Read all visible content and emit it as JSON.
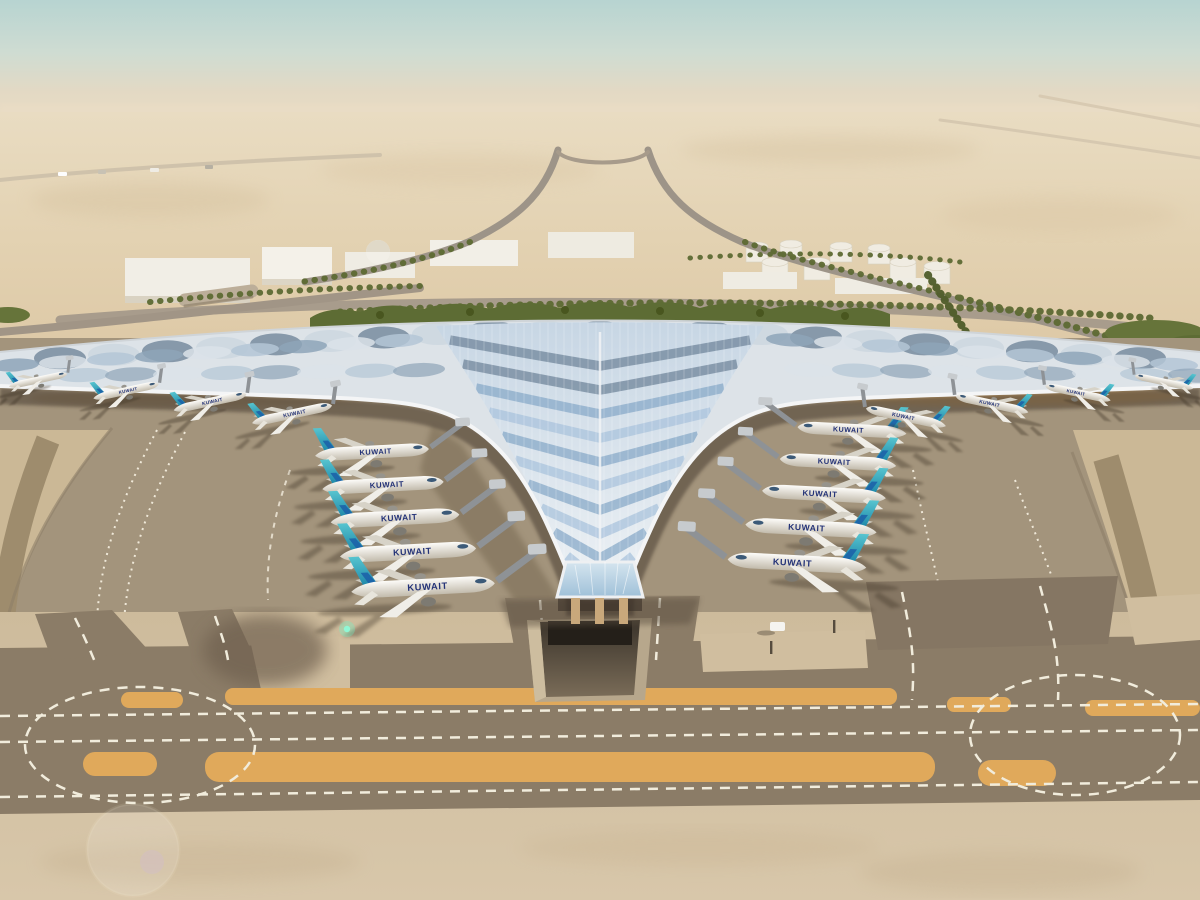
{
  "scene": {
    "sky_top": "#b7d4d1",
    "sky_mid": "#cfdcd2",
    "sky_horizon": "#e6d9c3",
    "desert_far": "#e9dcc2",
    "desert_near": "#ddc8a5",
    "greenery": "#5d6c34",
    "palm_line": "#5d6a33",
    "road": "#9d9488"
  },
  "ground": {
    "apron": "#a3947c",
    "taxiway_dark": "#8b7c67",
    "pavement_light": "#d2c0a2",
    "sand_strip_color": "#e0a95b",
    "dash_color": "#f1ecdc",
    "stand_line_color": "#efe8d8",
    "wedge_stripe": "#9e8c6d"
  },
  "terminal": {
    "roof_base": "#dde3e8",
    "canopy_top": "#c7d6e4",
    "canopy_bottom": "#eef2f5",
    "chevron_light": "#a9c3dc",
    "chevron_mid": "#88a9c8",
    "chevron_dark": "#70869b",
    "bump_dark": "#7d90a3",
    "bump_light": "#cdd7e0",
    "edge_trim": "#f4f5f6",
    "under_shadow": "#41362a",
    "column_tan": "#c9a87b",
    "glass_light": "#d5e5ef",
    "glass_deep": "#9fc0d8"
  },
  "aircraft": {
    "livery_label": "KUWAIT",
    "label_color": "#233277",
    "tail_teal_light": "#57c4cf",
    "tail_teal_deep": "#1d86a8",
    "tail_accent_blue": "#1b5fa8",
    "fuselage_top": "#fdfcf9",
    "fuselage_bottom": "#c2bbac",
    "groups": [
      {
        "name": "left-gate-column",
        "dir": 1,
        "rotation": -3,
        "bridge": [
          36,
          -24
        ],
        "planes": [
          [
            372,
            452,
            0.92
          ],
          [
            383,
            485,
            0.98
          ],
          [
            395,
            518,
            1.04
          ],
          [
            408,
            552,
            1.1
          ],
          [
            423,
            587,
            1.16
          ]
        ]
      },
      {
        "name": "right-gate-column",
        "dir": -1,
        "rotation": 3,
        "bridge": [
          36,
          -24
        ],
        "planes": [
          [
            852,
            430,
            0.88
          ],
          [
            838,
            462,
            0.94
          ],
          [
            824,
            494,
            1.0
          ],
          [
            811,
            528,
            1.06
          ],
          [
            797,
            563,
            1.12
          ]
        ]
      },
      {
        "name": "left-wing-row",
        "dir": 1,
        "rotation": -12,
        "bridge": [
          10,
          -28
        ],
        "planes": [
          [
            38,
            380,
            0.48
          ],
          [
            126,
            391,
            0.54
          ],
          [
            210,
            402,
            0.6
          ],
          [
            292,
            414,
            0.66
          ]
        ]
      },
      {
        "name": "right-wing-row",
        "dir": -1,
        "rotation": 12,
        "bridge": [
          10,
          -28
        ],
        "planes": [
          [
            1164,
            382,
            0.48
          ],
          [
            1078,
            393,
            0.54
          ],
          [
            992,
            404,
            0.6
          ],
          [
            906,
            417,
            0.66
          ]
        ]
      }
    ]
  }
}
